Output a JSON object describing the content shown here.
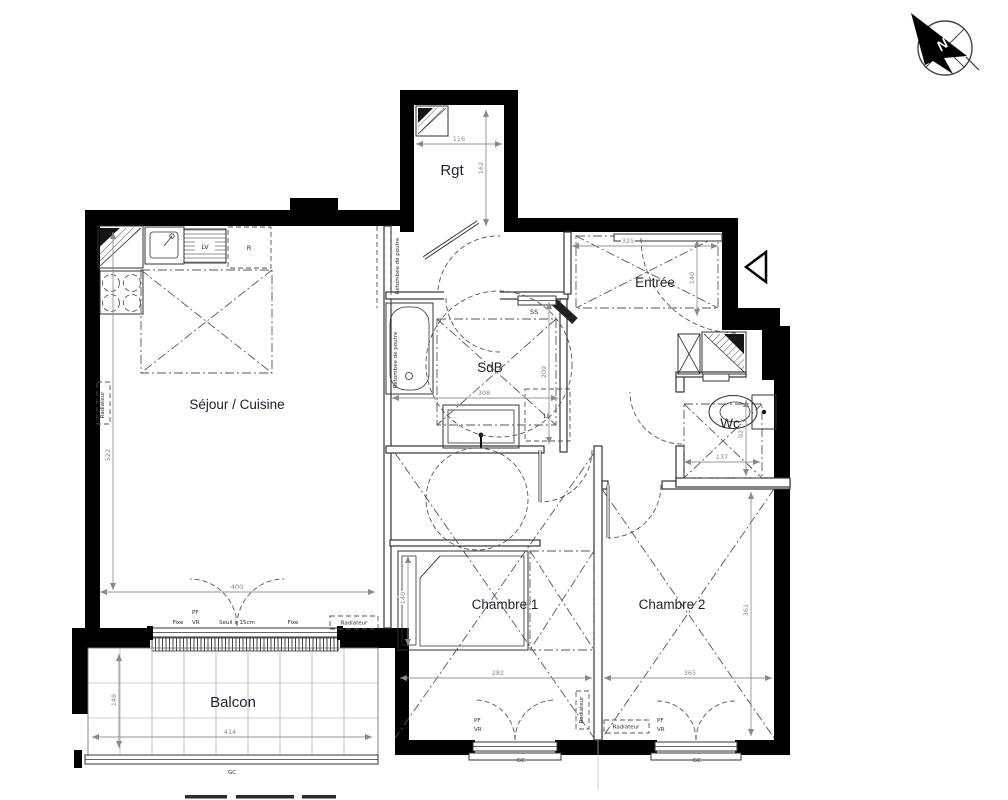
{
  "compass": {
    "north_label": "N"
  },
  "rooms": {
    "sejour": "Séjour / Cuisine",
    "rgt": "Rgt",
    "entree": "Entrée",
    "sdb": "SdB",
    "wc": "Wc",
    "chambre1": "Chambre 1",
    "chambre2": "Chambre 2",
    "balcon": "Balcon"
  },
  "fixtures": {
    "lave_vaisselle": "LV",
    "refrigerateur": "R",
    "lave_linge": "LL",
    "seche_serviettes": "SS"
  },
  "annotations": {
    "retombee_poutre": "Retombée de poutre",
    "seuil": "Seuil à 15cm",
    "fixe": "Fixe",
    "pf": "PF",
    "vr": "VR",
    "gc": "GC",
    "radiateur": "Radiateur"
  },
  "dimensions": {
    "rgt_w": "116",
    "rgt_h": "162",
    "entree_w": "325",
    "entree_h": "140",
    "sejour_h": "522",
    "bay_w": "400",
    "sdb_w": "308",
    "sdb_h": "209",
    "wc_w": "137",
    "wc_h": "92",
    "ch1_w": "282",
    "bed_w": "140",
    "ch2_w": "365",
    "ch2_h": "361",
    "balcon_w": "414",
    "balcon_h": "148"
  },
  "colors": {
    "wall": "#000000",
    "label": "#1d2030",
    "dimension": "#8a8a8a"
  }
}
